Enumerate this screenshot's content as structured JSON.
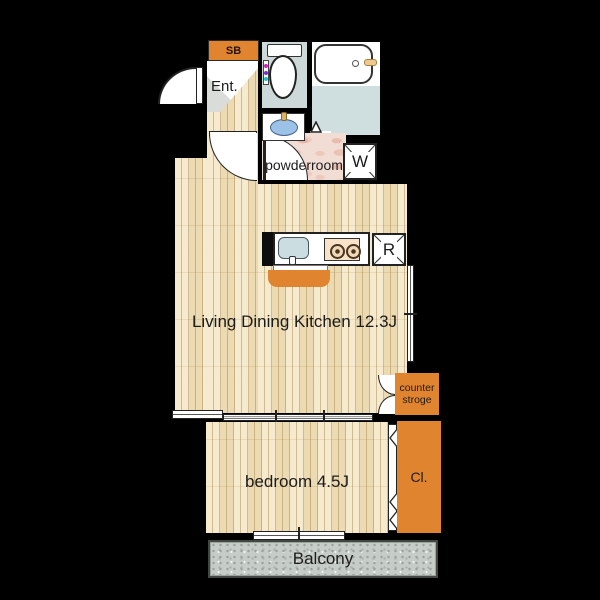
{
  "plan_title": "1LDK apartment floor plan",
  "labels": {
    "shoe_box": "SB",
    "entrance": "Ent.",
    "powder_room": "powderroom",
    "washing_machine": "W",
    "refrigerator": "R",
    "living_dining_kitchen": "Living Dining Kitchen 12.3J",
    "counter_storage_line1": "counter",
    "counter_storage_line2": "stroge",
    "bedroom": "bedroom 4.5J",
    "closet": "Cl.",
    "balcony": "Balcony"
  },
  "colors": {
    "background": "#000000",
    "accent_orange": "#e0842f",
    "wood_floor": "#f3e4c1",
    "wet_area_floor": "#cdd9d8",
    "powder_floor_pink": "#f2ddd5",
    "balcony_gray": "#c6cdc8",
    "vanity_sink_blue": "#9cc2e8",
    "kitchen_sink_blue": "#ccdde2",
    "bidet_dot_magenta": "#d61fc4",
    "bidet_dot_purple": "#7b2bd6",
    "bidet_dot_cyan": "#12c3cf"
  }
}
